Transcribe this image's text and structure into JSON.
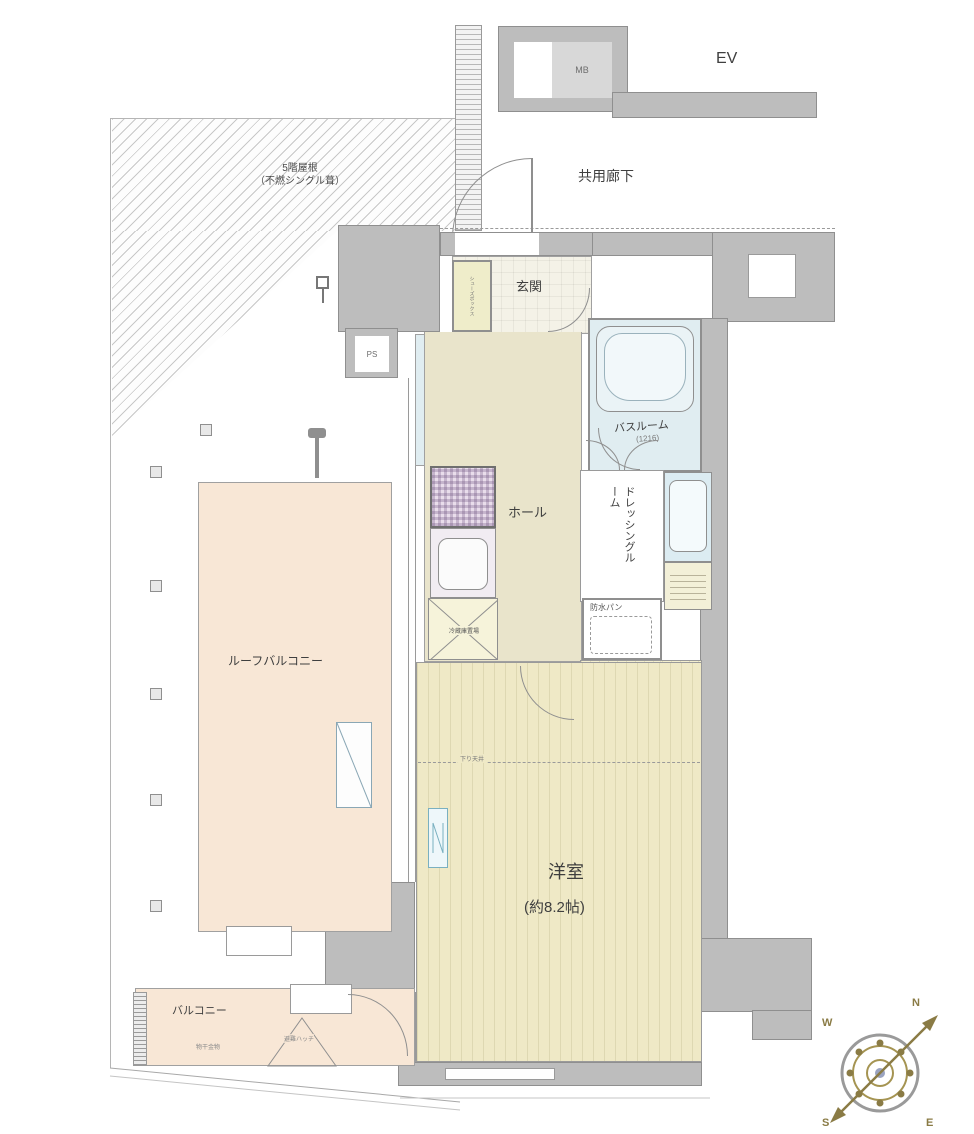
{
  "labels": {
    "ev": "EV",
    "mb": "MB",
    "ps": "PS",
    "common_corridor": "共用廊下",
    "roof_line1": "5階屋根",
    "roof_line2": "（不燃シングル葺）",
    "entrance": "玄関",
    "shoe_box": "シューズボックス",
    "toilet": "トイレ",
    "hall": "ホール",
    "bathroom": "バスルーム",
    "bathroom_size": "(1216)",
    "dressing_room": "ドレッシングルーム",
    "waterproof_pan": "防水パン",
    "walk_in_closet_line1": "ウォークイン",
    "walk_in_closet_line2": "クローゼット",
    "fridge_space": "冷蔵庫置場",
    "lowered_ceiling": "下り天井",
    "western_room": "洋室",
    "western_room_size": "(約8.2帖)",
    "roof_balcony": "ルーフバルコニー",
    "balcony": "バルコニー",
    "laundry_hardware": "物干金物",
    "evacuation_hatch": "避難ハッチ",
    "compass_n": "N",
    "compass_e": "E",
    "compass_s": "S",
    "compass_w": "W"
  },
  "colors": {
    "wall": "#bdbdbd",
    "tatami_floor": "#efe9c6",
    "water_room": "#e0edf1",
    "balcony_floor": "#f8e7d6",
    "compass_gold": "#8a7b45"
  }
}
